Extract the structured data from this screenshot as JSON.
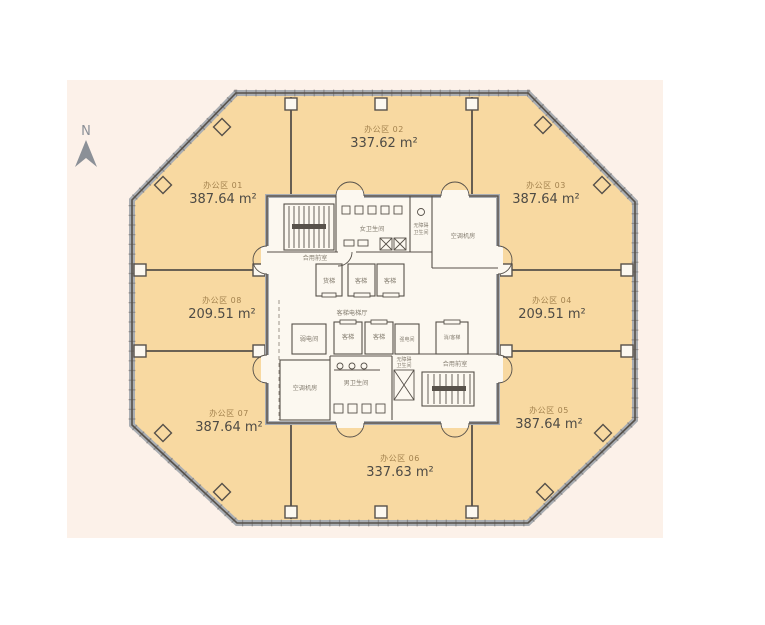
{
  "north_arrow": {
    "label": "N"
  },
  "zones": [
    {
      "name": "办公区 01",
      "area": "387.64 m²"
    },
    {
      "name": "办公区 02",
      "area": "337.62 m²"
    },
    {
      "name": "办公区 03",
      "area": "387.64 m²"
    },
    {
      "name": "办公区 04",
      "area": "209.51 m²"
    },
    {
      "name": "办公区 05",
      "area": "387.64 m²"
    },
    {
      "name": "办公区 06",
      "area": "337.63 m²"
    },
    {
      "name": "办公区 07",
      "area": "387.64 m²"
    },
    {
      "name": "办公区 08",
      "area": "209.51 m²"
    }
  ],
  "core_rooms": {
    "shared_vestibule_top": "合用前室",
    "freight_elevator": "货梯",
    "passenger_elevator_a": "客梯",
    "passenger_elevator_b": "客梯",
    "womens_restroom": "女卫生间",
    "accessible_restroom_top_l1": "无障碍",
    "accessible_restroom_top_l2": "卫生间",
    "ac_plant_room_top": "空调机房",
    "passenger_elevator_hall": "客梯电梯厅",
    "low_voltage_room": "弱电间",
    "passenger_elevator_c": "客梯",
    "passenger_elevator_d": "客梯",
    "high_voltage_room": "强电间",
    "fire_passenger_elevator": "消/客梯",
    "accessible_restroom_bottom_l1": "无障碍",
    "accessible_restroom_bottom_l2": "卫生间",
    "shared_vestibule_bottom": "合用前室",
    "ac_plant_room_bottom": "空调机房",
    "mens_restroom": "男卫生间"
  },
  "colors": {
    "panel_bg": "#FCF1E9",
    "office_fill": "#F8D9A1",
    "facade_gray": "#A9ADB2",
    "line_dark": "#57514A",
    "core_bg": "#FCF8F0",
    "zone_name": "#A3824E",
    "zone_area": "#4E4B45",
    "room_label": "#857E71",
    "north_arrow": "#8B9097"
  }
}
